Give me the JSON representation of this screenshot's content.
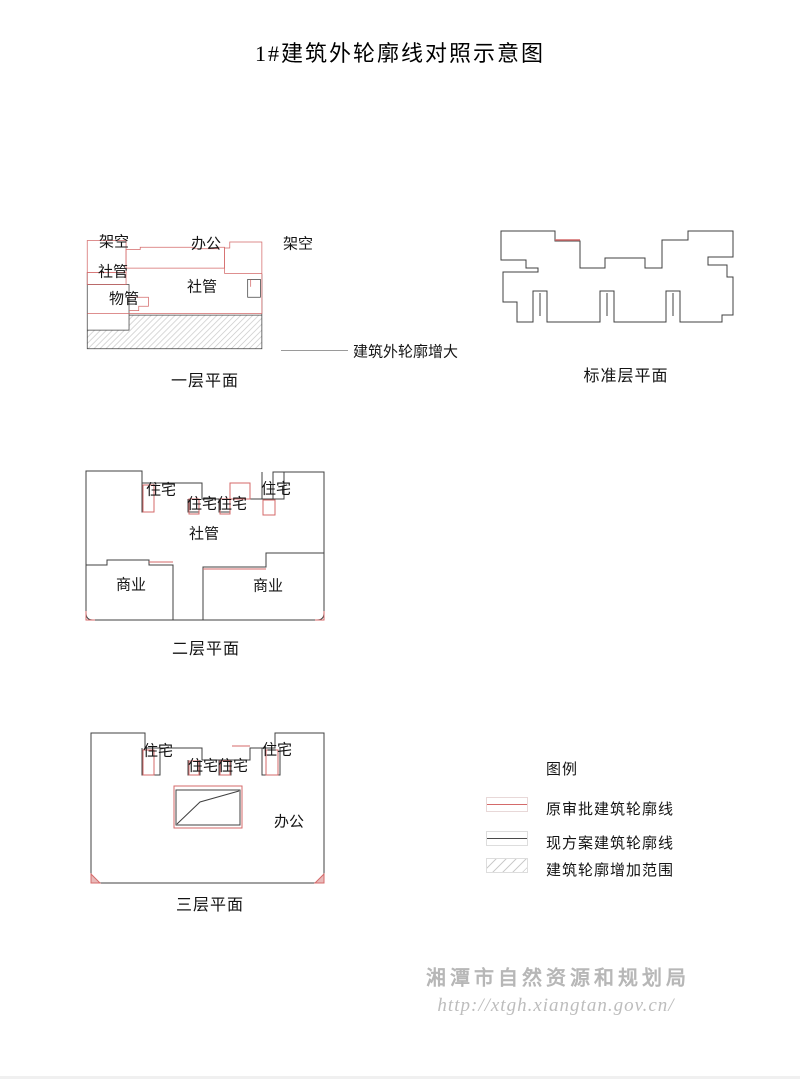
{
  "title": "1#建筑外轮廓线对照示意图",
  "plans": {
    "floor1": {
      "caption": "一层平面",
      "labels": {
        "jiakong_left": "架空",
        "bangong": "办公",
        "jiakong_right": "架空",
        "sheguan_small": "社管",
        "wuguan": "物管",
        "sheguan": "社管"
      }
    },
    "floor2": {
      "caption": "二层平面",
      "labels": {
        "zhuzhai_left": "住宅",
        "zhuzhai_mid1": "住宅",
        "zhuzhai_mid2": "住宅",
        "zhuzhai_right": "住宅",
        "sheguan": "社管",
        "shangye_left": "商业",
        "shangye_right": "商业"
      }
    },
    "floor3": {
      "caption": "三层平面",
      "labels": {
        "zhuzhai_left": "住宅",
        "zhuzhai_mid1": "住宅",
        "zhuzhai_mid2": "住宅",
        "zhuzhai_right": "住宅",
        "bangong": "办公"
      }
    },
    "standard": {
      "caption": "标准层平面"
    }
  },
  "annotation": {
    "text": "建筑外轮廓增大"
  },
  "legend": {
    "title": "图例",
    "items": [
      {
        "label": "原审批建筑轮廓线",
        "swatch": "red-line",
        "color": "#d46a6a"
      },
      {
        "label": "现方案建筑轮廓线",
        "swatch": "black-line",
        "color": "#4a4a4a"
      },
      {
        "label": "建筑轮廓增加范围",
        "swatch": "hatch",
        "color": "#cccccc"
      }
    ]
  },
  "watermark": {
    "org": "湘潭市自然资源和规划局",
    "url": "http://xtgh.xiangtan.gov.cn/"
  },
  "colors": {
    "approved_outline": "#d46a6a",
    "current_outline": "#404040",
    "hatch_line": "#c9c9c9"
  }
}
